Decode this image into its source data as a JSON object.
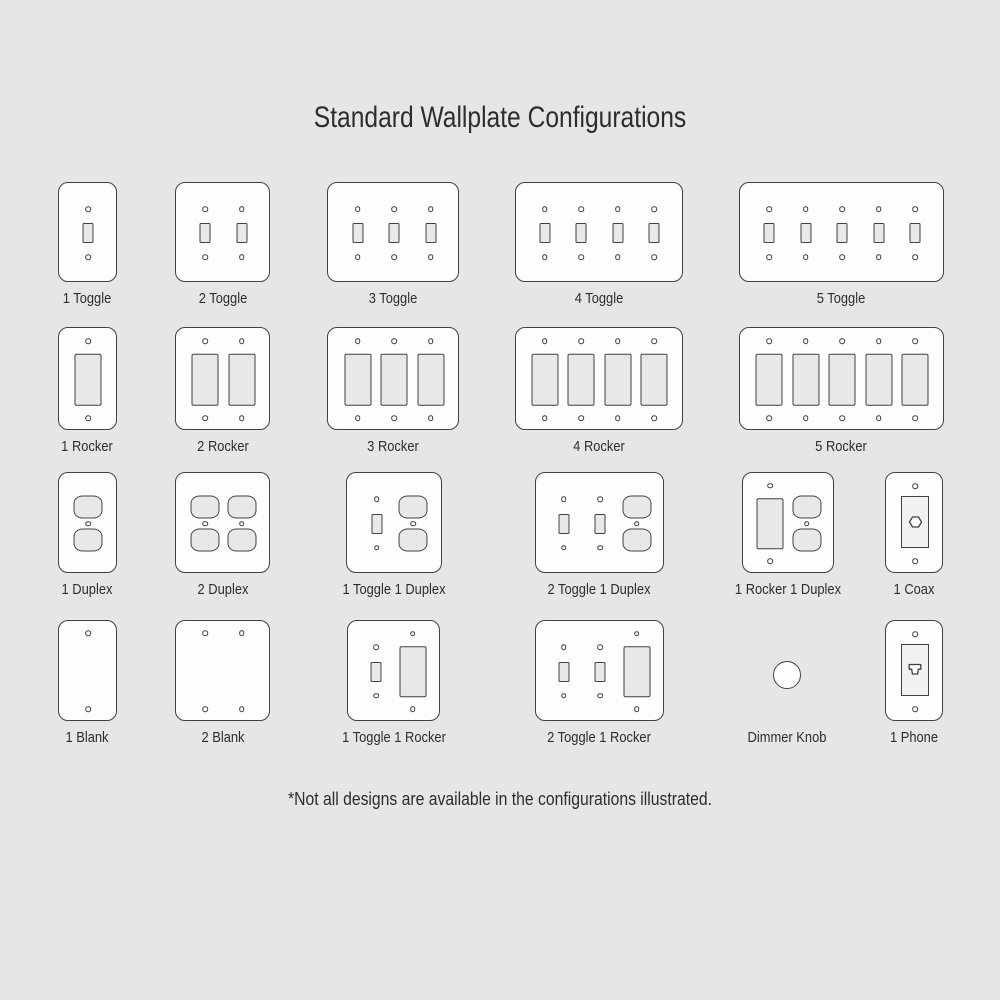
{
  "title": "Standard Wallplate Configurations",
  "footnote": "*Not all designs are available in the configurations illustrated.",
  "colors": {
    "background": "#e5e6e7",
    "plate": "#fdfdfd",
    "outline": "#414141",
    "device_fill": "#e8e8e9",
    "insert_fill": "#eff1f3",
    "text": "#2d2d2d"
  },
  "plates": [
    {
      "label": "1 Toggle",
      "gangs": [
        "toggle"
      ],
      "x": 57.5,
      "y": 182,
      "w": 59,
      "h": 100
    },
    {
      "label": "2 Toggle",
      "gangs": [
        "toggle",
        "toggle"
      ],
      "x": 175,
      "y": 182,
      "w": 95,
      "h": 100
    },
    {
      "label": "3 Toggle",
      "gangs": [
        "toggle",
        "toggle",
        "toggle"
      ],
      "x": 327,
      "y": 182,
      "w": 132,
      "h": 100
    },
    {
      "label": "4 Toggle",
      "gangs": [
        "toggle",
        "toggle",
        "toggle",
        "toggle"
      ],
      "x": 514.5,
      "y": 182,
      "w": 168,
      "h": 100
    },
    {
      "label": "5 Toggle",
      "gangs": [
        "toggle",
        "toggle",
        "toggle",
        "toggle",
        "toggle"
      ],
      "x": 738.5,
      "y": 182,
      "w": 205,
      "h": 100
    },
    {
      "label": "1 Rocker",
      "gangs": [
        "rocker"
      ],
      "x": 57.5,
      "y": 327,
      "w": 59,
      "h": 103
    },
    {
      "label": "2 Rocker",
      "gangs": [
        "rocker",
        "rocker"
      ],
      "x": 175,
      "y": 327,
      "w": 95,
      "h": 103
    },
    {
      "label": "3 Rocker",
      "gangs": [
        "rocker",
        "rocker",
        "rocker"
      ],
      "x": 327,
      "y": 327,
      "w": 132,
      "h": 103
    },
    {
      "label": "4 Rocker",
      "gangs": [
        "rocker",
        "rocker",
        "rocker",
        "rocker"
      ],
      "x": 514.5,
      "y": 327,
      "w": 168,
      "h": 103
    },
    {
      "label": "5 Rocker",
      "gangs": [
        "rocker",
        "rocker",
        "rocker",
        "rocker",
        "rocker"
      ],
      "x": 738.5,
      "y": 327,
      "w": 205,
      "h": 103
    },
    {
      "label": "1 Duplex",
      "gangs": [
        "duplex"
      ],
      "x": 57.5,
      "y": 472,
      "w": 59,
      "h": 101
    },
    {
      "label": "2 Duplex",
      "gangs": [
        "duplex",
        "duplex"
      ],
      "x": 175,
      "y": 472,
      "w": 95,
      "h": 101
    },
    {
      "label": "1 Toggle 1 Duplex",
      "gangs": [
        "toggle",
        "duplex"
      ],
      "x": 346,
      "y": 472,
      "w": 96,
      "h": 101
    },
    {
      "label": "2 Toggle 1 Duplex",
      "gangs": [
        "toggle",
        "toggle",
        "duplex"
      ],
      "x": 534.5,
      "y": 472,
      "w": 129,
      "h": 101
    },
    {
      "label": "1 Rocker 1 Duplex",
      "gangs": [
        "rocker",
        "duplex"
      ],
      "x": 741.5,
      "y": 472,
      "w": 92,
      "h": 101
    },
    {
      "label": "1 Coax",
      "gangs": [
        "coax"
      ],
      "x": 885,
      "y": 472,
      "w": 58,
      "h": 101
    },
    {
      "label": "1 Blank",
      "gangs": [
        "blank"
      ],
      "x": 57.5,
      "y": 620,
      "w": 59,
      "h": 101
    },
    {
      "label": "2 Blank",
      "gangs": [
        "blank",
        "blank"
      ],
      "x": 175,
      "y": 620,
      "w": 95,
      "h": 101
    },
    {
      "label": "1 Toggle 1 Rocker",
      "gangs": [
        "toggle",
        "rocker"
      ],
      "x": 347,
      "y": 620,
      "w": 93,
      "h": 101
    },
    {
      "label": "2 Toggle 1 Rocker",
      "gangs": [
        "toggle",
        "toggle",
        "rocker"
      ],
      "x": 534.5,
      "y": 620,
      "w": 129,
      "h": 101
    },
    {
      "label": "Dimmer Knob",
      "gangs": [
        "knob"
      ],
      "frameless": true,
      "x": 773,
      "y": 620,
      "w": 28,
      "h": 101
    },
    {
      "label": "1 Phone",
      "gangs": [
        "phone"
      ],
      "x": 885,
      "y": 620,
      "w": 58,
      "h": 101
    }
  ]
}
